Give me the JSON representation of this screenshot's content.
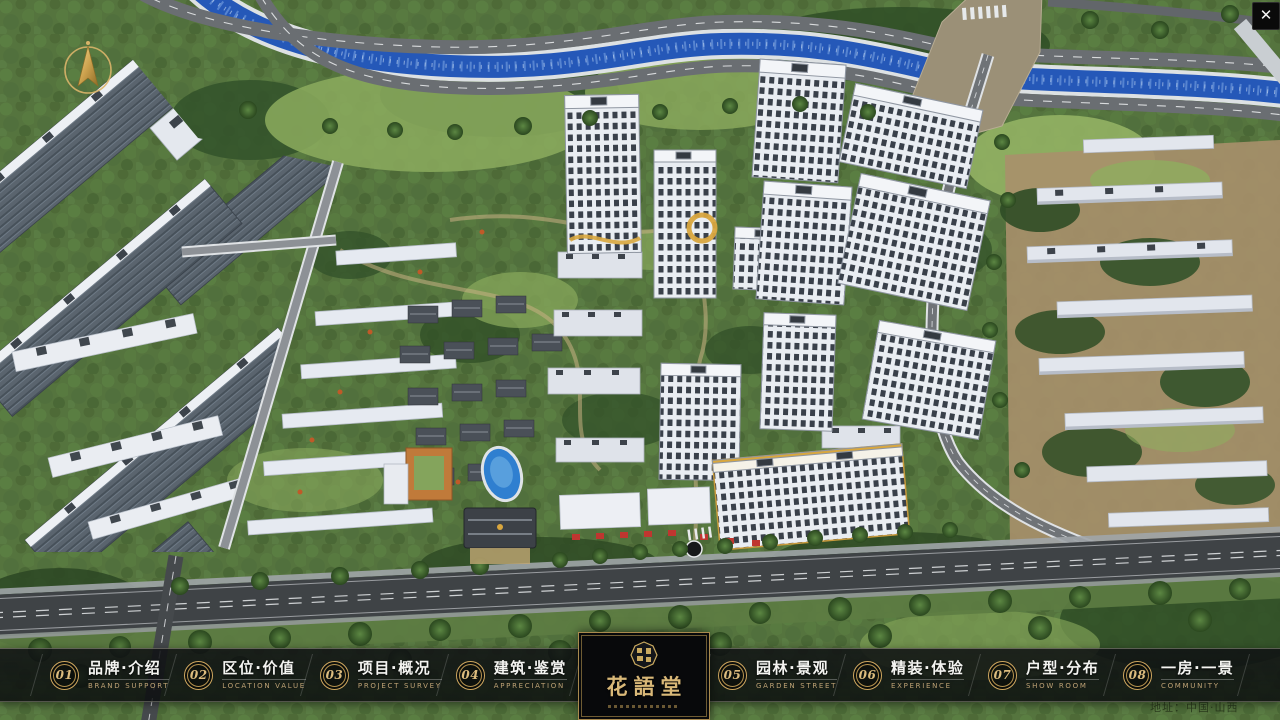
{
  "window": {
    "close_glyph": "✕"
  },
  "navbar": {
    "items": [
      {
        "num": "01",
        "zh": "品牌·介绍",
        "en": "BRAND SUPPORT"
      },
      {
        "num": "02",
        "zh": "区位·价值",
        "en": "LOCATION VALUE"
      },
      {
        "num": "03",
        "zh": "项目·概况",
        "en": "PROJECT SURVEY"
      },
      {
        "num": "04",
        "zh": "建筑·鉴赏",
        "en": "APPRECIATION"
      },
      {
        "num": "05",
        "zh": "园林·景观",
        "en": "GARDEN STREET"
      },
      {
        "num": "06",
        "zh": "精装·体验",
        "en": "EXPERIENCE"
      },
      {
        "num": "07",
        "zh": "户型·分布",
        "en": "SHOW ROOM"
      },
      {
        "num": "08",
        "zh": "一房·一景",
        "en": "COMMUNITY"
      }
    ]
  },
  "logo": {
    "title": "花語堂"
  },
  "footer": {
    "address": "地址：中国·山西"
  },
  "colors": {
    "gold": "#cfa75f",
    "bar_bg": "rgba(10,12,14,0.82)",
    "river": "#2558b8",
    "road": "#6a6e72"
  }
}
